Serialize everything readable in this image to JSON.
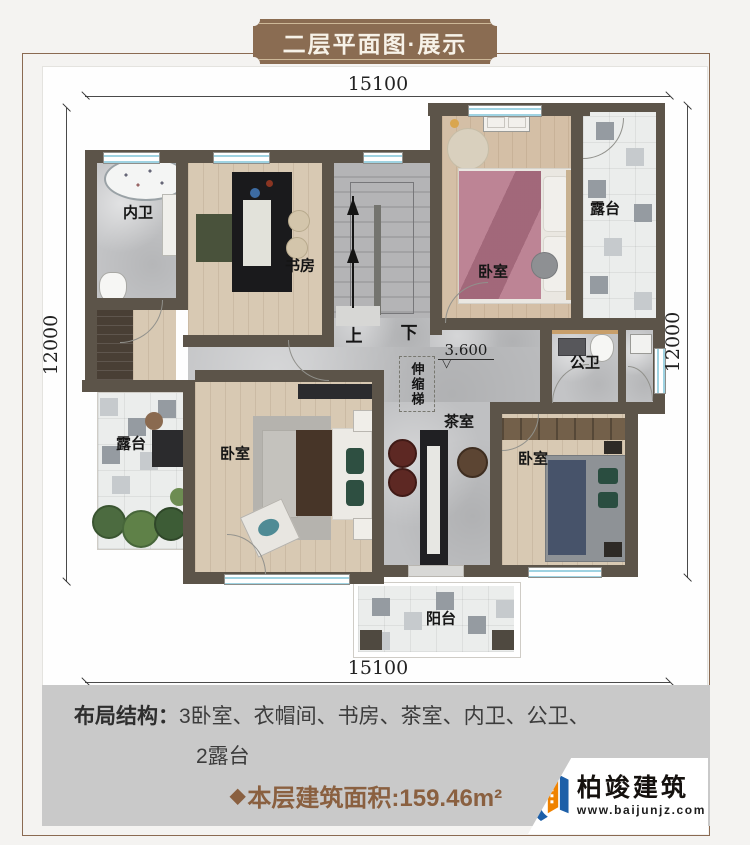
{
  "banner": {
    "title": "二层平面图·展示"
  },
  "dimensions": {
    "top": "15100",
    "bottom": "15100",
    "left": "12000",
    "right": "12000"
  },
  "plan": {
    "rooms": {
      "inner_bath": "内卫",
      "study": "书房",
      "bedroom_top": "卧室",
      "terrace_right": "露台",
      "public_bath": "公卫",
      "tea_room": "茶室",
      "bedroom_left": "卧室",
      "bedroom_right": "卧室",
      "terrace_left": "露台",
      "balcony": "阳台"
    },
    "stairs": {
      "up": "上",
      "down": "下"
    },
    "ladder_label": "伸缩梯",
    "level_mark": "3.600",
    "level_triangle": "▽"
  },
  "footer": {
    "layout_label": "布局结构：",
    "layout_items_line1": "3卧室、衣帽间、书房、茶室、内卫、公卫、",
    "layout_items_line2": "2露台",
    "area_diamond": "◆",
    "area_text": "本层建筑面积:159.46m²",
    "logo_name": "柏竣建筑",
    "logo_url": "www.baijunjz.com"
  }
}
